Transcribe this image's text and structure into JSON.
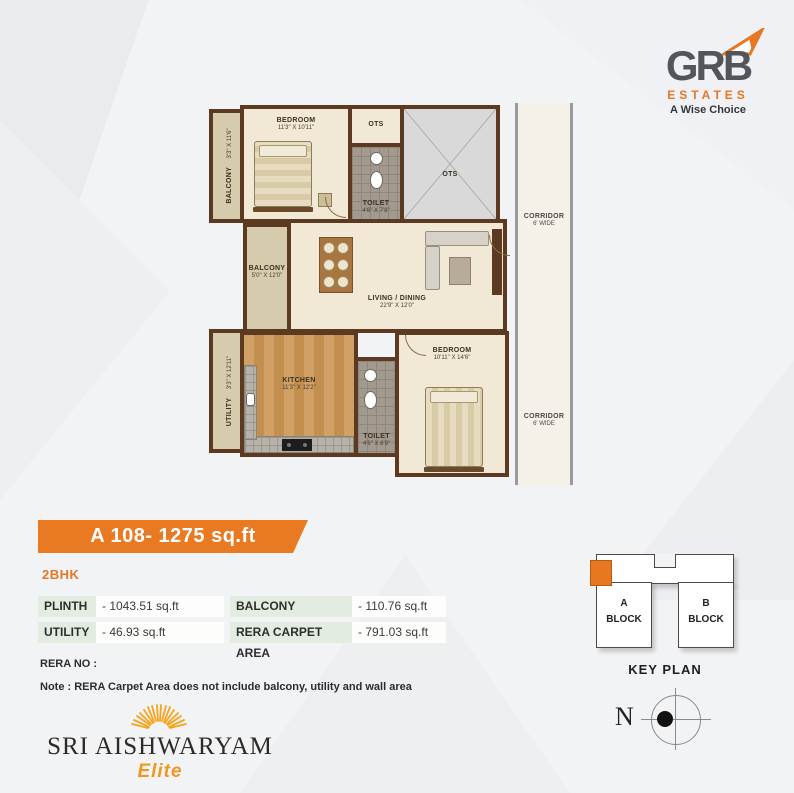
{
  "brand": {
    "name": "GRB",
    "sub": "ESTATES",
    "tagline": "A Wise Choice"
  },
  "floorplan": {
    "rooms": {
      "balcony1": {
        "name": "BALCONY",
        "dims": "3'3\" X 11'6\""
      },
      "bedroom1": {
        "name": "BEDROOM",
        "dims": "11'3\" X 10'11\""
      },
      "ots1": {
        "name": "OTS"
      },
      "toilet1": {
        "name": "TOILET",
        "dims": "4'6\" X 7'8\""
      },
      "shaft": {
        "name": "OTS"
      },
      "balcony2": {
        "name": "BALCONY",
        "dims": "5'0\" X 12'0\""
      },
      "living": {
        "name": "LIVING / DINING",
        "dims": "22'9\" X 12'0\""
      },
      "utility": {
        "name": "UTILITY",
        "dims": "3'3\" X 12'11\""
      },
      "kitchen": {
        "name": "KITCHEN",
        "dims": "11'3\" X 12'2\""
      },
      "toilet2": {
        "name": "TOILET",
        "dims": "4'6\" X 8'9\""
      },
      "bedroom2": {
        "name": "BEDROOM",
        "dims": "10'11\" X 14'6\""
      },
      "corridor_top": {
        "name": "CORRIDOR",
        "dims": "6' WIDE"
      },
      "corridor_bottom": {
        "name": "CORRIDOR",
        "dims": "6' WIDE"
      }
    }
  },
  "unit_banner": "A 108- 1275 sq.ft",
  "unit_type": "2BHK",
  "area_table": {
    "rows": [
      {
        "cells": [
          {
            "label": "PLINTH",
            "value": "- 1043.51 sq.ft"
          },
          {
            "label": "BALCONY",
            "value": "- 110.76 sq.ft"
          }
        ]
      },
      {
        "cells": [
          {
            "label": "UTILITY",
            "value": "- 46.93 sq.ft"
          },
          {
            "label": "RERA CARPET AREA",
            "value": "- 791.03 sq.ft"
          }
        ]
      }
    ]
  },
  "rera": {
    "label": "RERA NO :",
    "note": "Note : RERA Carpet Area does not include balcony, utility and wall area"
  },
  "key_plan": {
    "a_letter": "A",
    "b_letter": "B",
    "block_word": "BLOCK",
    "label": "KEY PLAN"
  },
  "compass": {
    "north_label": "N"
  },
  "project": {
    "name": "SRI AISHWARYAM",
    "edition": "Elite"
  },
  "colors": {
    "accent_orange": "#EA7A22",
    "wall_brown": "#5B3A21",
    "table_label_green": "#E3ECE0"
  }
}
